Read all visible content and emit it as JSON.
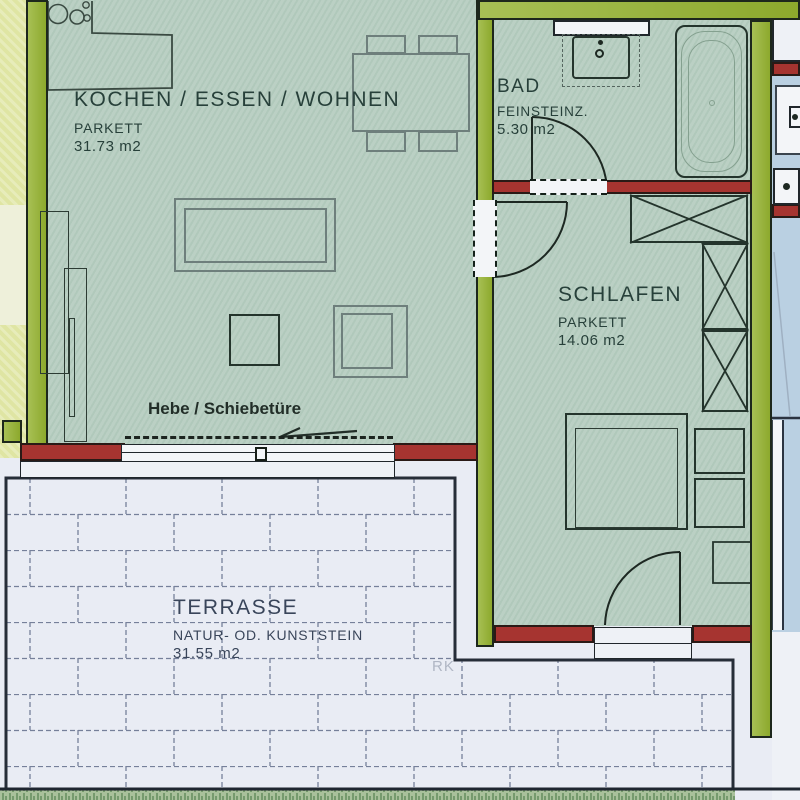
{
  "plan": {
    "rooms": {
      "kochen": {
        "name": "KOCHEN / ESSEN / WOHNEN",
        "floor": "PARKETT",
        "area": "31.73 m2"
      },
      "bad": {
        "name": "BAD",
        "floor": "FEINSTEINZ.",
        "area": "5.30 m2"
      },
      "schlafen": {
        "name": "SCHLAFEN",
        "floor": "PARKETT",
        "area": "14.06 m2"
      },
      "terrasse": {
        "name": "TERRASSE",
        "floor": "NATUR- OD. KUNSTSTEIN",
        "area": "31.55 m2"
      }
    },
    "annotations": {
      "sliding_door": "Hebe / Schiebetüre",
      "watermark": "RK"
    },
    "colors": {
      "exterior_wall_green": "#94b22f",
      "interior_wall_red": "#a63430",
      "floor_green": "#b7cec1",
      "terrace_stone": "#e9ecf4",
      "outside_yellow": "#dfe5a3",
      "neighbor_blue": "#bad0e2",
      "line_dark": "#1d271c"
    }
  }
}
